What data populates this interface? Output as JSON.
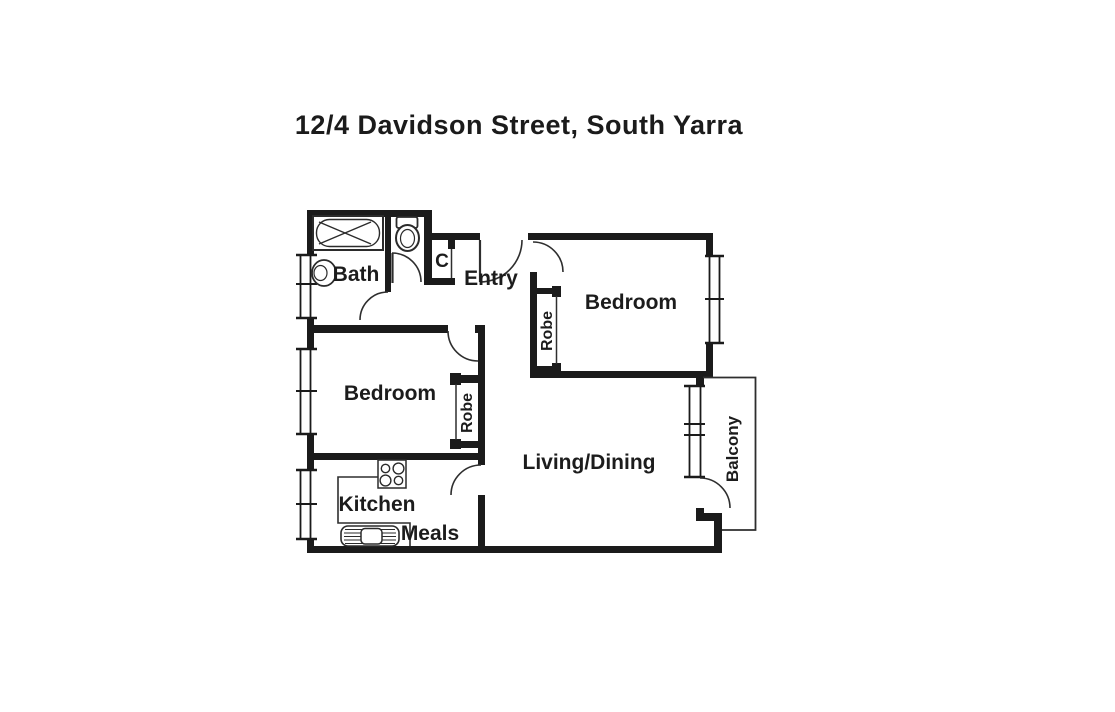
{
  "title": "12/4 Davidson Street, South Yarra",
  "plan": {
    "labels": {
      "bath": "Bath",
      "cupboard": "C",
      "entry": "Entry",
      "bedroom_right": "Bedroom",
      "robe_right": "Robe",
      "bedroom_left": "Bedroom",
      "robe_left": "Robe",
      "living_dining": "Living/Dining",
      "kitchen": "Kitchen",
      "meals": "Meals",
      "balcony": "Balcony"
    },
    "fixtures": {
      "bathtub": "bathtub",
      "toilet": "toilet",
      "basin": "basin",
      "stove": "cooktop-4-burners",
      "sink": "kitchen-sink"
    },
    "colors": {
      "wall": "#1b1b1b",
      "line": "#2e2e2e",
      "background": "#ffffff",
      "text": "#1c1c1c"
    }
  }
}
